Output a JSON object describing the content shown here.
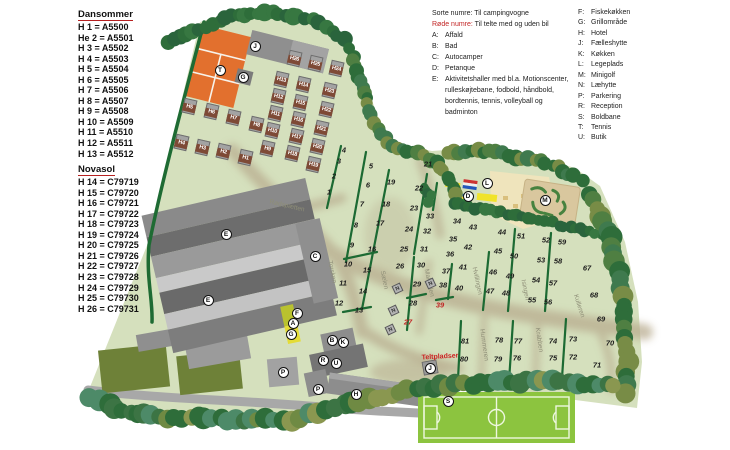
{
  "left_legend": {
    "dansommer_title": "Dansommer",
    "dansommer_items": [
      "H 1 = A5500",
      "He 2 = A5501",
      "H 3 = A5502",
      "H 4 = A5503",
      "H 5 = A5504",
      "H 6 = A5505",
      "H 7 = A5506",
      "H 8 = A5507",
      "H 9 = A5508",
      "H 10 = A5509",
      "H 11 = A5510",
      "H 12 = A5511",
      "H 13 = A5512"
    ],
    "novasol_title": "Novasol",
    "novasol_items": [
      "H 14 = C79719",
      "H 15 = C79720",
      "H 16 = C79721",
      "H 17 = C79722",
      "H 18 = C79723",
      "H 19 = C79724",
      "H 20 = C79725",
      "H 21 = C79726",
      "H 22 = C79727",
      "H 23 = C79728",
      "H 24 = C79729",
      "H 25 = C79730",
      "H 26  = C79731"
    ]
  },
  "key_legend": {
    "line_black": "Sorte numre: Til campingvogne",
    "line_red_prefix": "Røde numre:",
    "line_red_rest": " Til telte med og uden bil",
    "items": [
      {
        "key": "A:",
        "label": "Affald"
      },
      {
        "key": "B:",
        "label": "Bad"
      },
      {
        "key": "C:",
        "label": "Autocamper"
      },
      {
        "key": "D:",
        "label": "Petanque"
      },
      {
        "key": "E:",
        "label": "Aktivitetshaller med bl.a. Motionscenter, rulleskøjtebane, fodbold, håndbold, bordtennis, tennis, volleyball og badminton"
      }
    ]
  },
  "facility_legend": {
    "items": [
      {
        "key": "F:",
        "label": "Fiskekøkken"
      },
      {
        "key": "G:",
        "label": "Grillområde"
      },
      {
        "key": "H:",
        "label": "Hotel"
      },
      {
        "key": "J:",
        "label": "Fælleshytte"
      },
      {
        "key": "K:",
        "label": "Køkken"
      },
      {
        "key": "L:",
        "label": "Legeplads"
      },
      {
        "key": "M:",
        "label": "Minigolf"
      },
      {
        "key": "N:",
        "label": "Læhytte"
      },
      {
        "key": "P:",
        "label": "Parkering"
      },
      {
        "key": "R:",
        "label": "Reception"
      },
      {
        "key": "S:",
        "label": "Boldbane"
      },
      {
        "key": "T:",
        "label": "Tennis"
      },
      {
        "key": "U:",
        "label": "Butik"
      }
    ]
  },
  "map": {
    "colors": {
      "map_green": "#d5e0bd",
      "tree_dark": "#2e6d3a",
      "building_gray": "#8d8d8d",
      "tennis_orange": "#e2702e",
      "red_number": "#c22525",
      "football_green": "#8cc43f",
      "road_tan": "#b7aa8d",
      "sand": "#efe4bc",
      "minigolf_tan": "#d9c79e"
    },
    "tent_area_label": {
      "text": "Teltpladser",
      "x": 440,
      "y": 357
    },
    "markers": [
      {
        "letter": "T",
        "x": 220,
        "y": 70
      },
      {
        "letter": "J",
        "x": 255,
        "y": 46
      },
      {
        "letter": "G",
        "x": 243,
        "y": 77
      },
      {
        "letter": "E",
        "x": 226,
        "y": 234
      },
      {
        "letter": "E",
        "x": 208,
        "y": 300
      },
      {
        "letter": "C",
        "x": 315,
        "y": 256
      },
      {
        "letter": "F",
        "x": 297,
        "y": 313
      },
      {
        "letter": "A",
        "x": 293,
        "y": 323
      },
      {
        "letter": "G",
        "x": 291,
        "y": 334
      },
      {
        "letter": "B",
        "x": 332,
        "y": 340
      },
      {
        "letter": "K",
        "x": 343,
        "y": 342
      },
      {
        "letter": "R",
        "x": 323,
        "y": 360
      },
      {
        "letter": "U",
        "x": 336,
        "y": 363
      },
      {
        "letter": "P",
        "x": 283,
        "y": 372
      },
      {
        "letter": "P",
        "x": 318,
        "y": 389
      },
      {
        "letter": "H",
        "x": 356,
        "y": 394
      },
      {
        "letter": "D",
        "x": 468,
        "y": 196
      },
      {
        "letter": "L",
        "x": 487,
        "y": 183
      },
      {
        "letter": "M",
        "x": 545,
        "y": 200
      },
      {
        "letter": "J",
        "x": 430,
        "y": 368
      },
      {
        "letter": "S",
        "x": 448,
        "y": 401
      }
    ],
    "small_huts": [
      {
        "letter": "N",
        "x": 397,
        "y": 288
      },
      {
        "letter": "N",
        "x": 393,
        "y": 310
      },
      {
        "letter": "N",
        "x": 390,
        "y": 329
      },
      {
        "letter": "N",
        "x": 430,
        "y": 283
      }
    ],
    "cabins": [
      {
        "label": "H1",
        "x": 245,
        "y": 157
      },
      {
        "label": "H2",
        "x": 223,
        "y": 151
      },
      {
        "label": "H3",
        "x": 202,
        "y": 147
      },
      {
        "label": "H4",
        "x": 181,
        "y": 142
      },
      {
        "label": "H5",
        "x": 189,
        "y": 106
      },
      {
        "label": "H6",
        "x": 211,
        "y": 111
      },
      {
        "label": "H7",
        "x": 233,
        "y": 117
      },
      {
        "label": "H8",
        "x": 256,
        "y": 124
      },
      {
        "label": "H9",
        "x": 267,
        "y": 148
      },
      {
        "label": "H10",
        "x": 272,
        "y": 130
      },
      {
        "label": "H11",
        "x": 275,
        "y": 113
      },
      {
        "label": "H12",
        "x": 278,
        "y": 96
      },
      {
        "label": "H13",
        "x": 281,
        "y": 79
      },
      {
        "label": "H14",
        "x": 303,
        "y": 84
      },
      {
        "label": "H15",
        "x": 300,
        "y": 102
      },
      {
        "label": "H16",
        "x": 298,
        "y": 119
      },
      {
        "label": "H17",
        "x": 296,
        "y": 136
      },
      {
        "label": "H18",
        "x": 292,
        "y": 153
      },
      {
        "label": "H19",
        "x": 313,
        "y": 164
      },
      {
        "label": "H20",
        "x": 317,
        "y": 146
      },
      {
        "label": "H21",
        "x": 321,
        "y": 128
      },
      {
        "label": "H22",
        "x": 326,
        "y": 109
      },
      {
        "label": "H23",
        "x": 329,
        "y": 90
      },
      {
        "label": "H24",
        "x": 336,
        "y": 68
      },
      {
        "label": "H25",
        "x": 315,
        "y": 63
      },
      {
        "label": "H26",
        "x": 294,
        "y": 58
      }
    ],
    "pitches": [
      {
        "n": "1",
        "x": 329,
        "y": 192
      },
      {
        "n": "2",
        "x": 334,
        "y": 176
      },
      {
        "n": "3",
        "x": 339,
        "y": 161
      },
      {
        "n": "4",
        "x": 344,
        "y": 150
      },
      {
        "n": "5",
        "x": 371,
        "y": 166
      },
      {
        "n": "6",
        "x": 368,
        "y": 185
      },
      {
        "n": "7",
        "x": 362,
        "y": 204
      },
      {
        "n": "8",
        "x": 356,
        "y": 225
      },
      {
        "n": "9",
        "x": 352,
        "y": 245
      },
      {
        "n": "10",
        "x": 348,
        "y": 264
      },
      {
        "n": "11",
        "x": 343,
        "y": 283
      },
      {
        "n": "12",
        "x": 339,
        "y": 303
      },
      {
        "n": "13",
        "x": 359,
        "y": 310
      },
      {
        "n": "14",
        "x": 363,
        "y": 291
      },
      {
        "n": "15",
        "x": 367,
        "y": 270
      },
      {
        "n": "16",
        "x": 372,
        "y": 249
      },
      {
        "n": "17",
        "x": 380,
        "y": 223
      },
      {
        "n": "18",
        "x": 386,
        "y": 204
      },
      {
        "n": "19",
        "x": 391,
        "y": 182
      },
      {
        "n": "21",
        "x": 428,
        "y": 164
      },
      {
        "n": "22",
        "x": 419,
        "y": 188
      },
      {
        "n": "23",
        "x": 414,
        "y": 208
      },
      {
        "n": "24",
        "x": 409,
        "y": 229
      },
      {
        "n": "25",
        "x": 404,
        "y": 249
      },
      {
        "n": "26",
        "x": 400,
        "y": 266
      },
      {
        "n": "27",
        "x": 408,
        "y": 322,
        "red": true
      },
      {
        "n": "28",
        "x": 413,
        "y": 303
      },
      {
        "n": "29",
        "x": 417,
        "y": 284
      },
      {
        "n": "30",
        "x": 421,
        "y": 265
      },
      {
        "n": "31",
        "x": 424,
        "y": 249
      },
      {
        "n": "32",
        "x": 427,
        "y": 231
      },
      {
        "n": "33",
        "x": 430,
        "y": 216
      },
      {
        "n": "34",
        "x": 457,
        "y": 221
      },
      {
        "n": "35",
        "x": 453,
        "y": 239
      },
      {
        "n": "36",
        "x": 450,
        "y": 254
      },
      {
        "n": "37",
        "x": 446,
        "y": 271
      },
      {
        "n": "38",
        "x": 443,
        "y": 285
      },
      {
        "n": "39",
        "x": 440,
        "y": 305,
        "red": true
      },
      {
        "n": "40",
        "x": 459,
        "y": 288
      },
      {
        "n": "41",
        "x": 463,
        "y": 267
      },
      {
        "n": "42",
        "x": 468,
        "y": 247
      },
      {
        "n": "43",
        "x": 473,
        "y": 227
      },
      {
        "n": "44",
        "x": 502,
        "y": 232
      },
      {
        "n": "45",
        "x": 498,
        "y": 251
      },
      {
        "n": "46",
        "x": 493,
        "y": 272
      },
      {
        "n": "47",
        "x": 490,
        "y": 291
      },
      {
        "n": "48",
        "x": 506,
        "y": 293
      },
      {
        "n": "49",
        "x": 510,
        "y": 276
      },
      {
        "n": "50",
        "x": 514,
        "y": 256
      },
      {
        "n": "51",
        "x": 521,
        "y": 236
      },
      {
        "n": "52",
        "x": 546,
        "y": 240
      },
      {
        "n": "53",
        "x": 541,
        "y": 260
      },
      {
        "n": "54",
        "x": 536,
        "y": 280
      },
      {
        "n": "55",
        "x": 532,
        "y": 300
      },
      {
        "n": "56",
        "x": 548,
        "y": 302
      },
      {
        "n": "57",
        "x": 553,
        "y": 283
      },
      {
        "n": "58",
        "x": 558,
        "y": 261
      },
      {
        "n": "59",
        "x": 562,
        "y": 242
      },
      {
        "n": "67",
        "x": 587,
        "y": 268
      },
      {
        "n": "68",
        "x": 594,
        "y": 295
      },
      {
        "n": "69",
        "x": 601,
        "y": 319
      },
      {
        "n": "70",
        "x": 610,
        "y": 343
      },
      {
        "n": "71",
        "x": 597,
        "y": 365
      },
      {
        "n": "72",
        "x": 573,
        "y": 357
      },
      {
        "n": "73",
        "x": 573,
        "y": 339
      },
      {
        "n": "74",
        "x": 553,
        "y": 341
      },
      {
        "n": "75",
        "x": 553,
        "y": 358
      },
      {
        "n": "76",
        "x": 517,
        "y": 358
      },
      {
        "n": "77",
        "x": 518,
        "y": 341
      },
      {
        "n": "78",
        "x": 499,
        "y": 340
      },
      {
        "n": "79",
        "x": 498,
        "y": 359
      },
      {
        "n": "80",
        "x": 464,
        "y": 359
      },
      {
        "n": "81",
        "x": 465,
        "y": 341
      }
    ],
    "streets": [
      {
        "name": "Rødspætten",
        "x": 287,
        "y": 206,
        "rot": 13
      },
      {
        "name": "Torsken",
        "x": 332,
        "y": 272,
        "rot": 78
      },
      {
        "name": "Sælen",
        "x": 384,
        "y": 280,
        "rot": 78
      },
      {
        "name": "Makrellen",
        "x": 429,
        "y": 283,
        "rot": 78
      },
      {
        "name": "Hvillingen",
        "x": 477,
        "y": 281,
        "rot": 78
      },
      {
        "name": "Isingen",
        "x": 525,
        "y": 290,
        "rot": 78
      },
      {
        "name": "Kulleren",
        "x": 579,
        "y": 306,
        "rot": 72
      },
      {
        "name": "Hummeren",
        "x": 484,
        "y": 345,
        "rot": 82
      },
      {
        "name": "Krabben",
        "x": 539,
        "y": 340,
        "rot": 82
      }
    ]
  }
}
